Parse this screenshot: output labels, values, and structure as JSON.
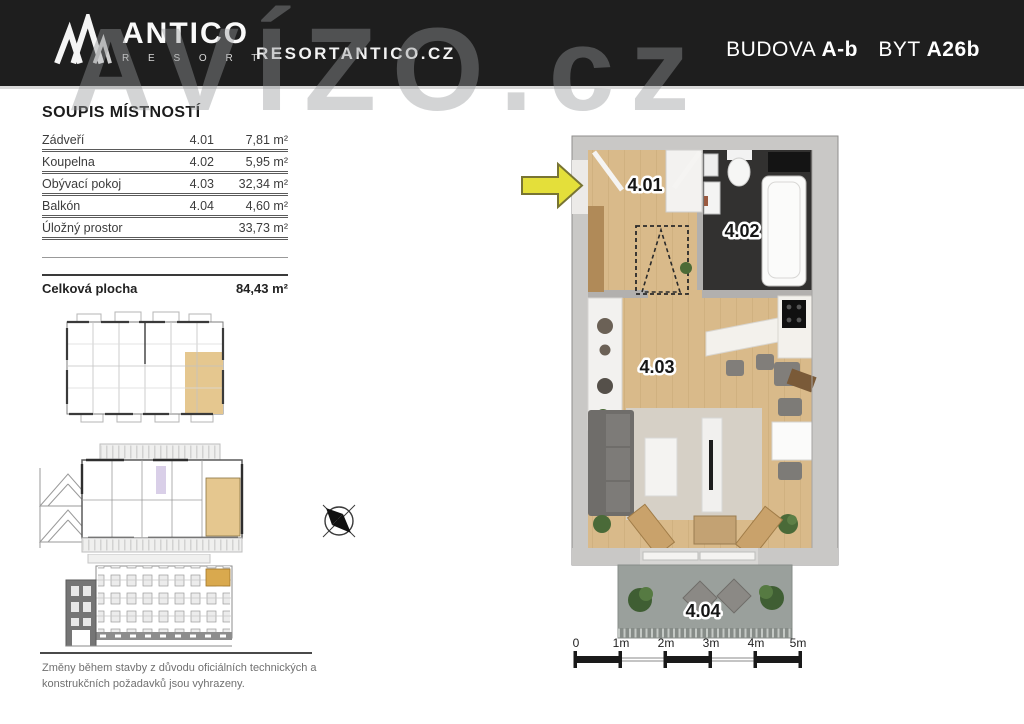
{
  "header": {
    "logo": {
      "brand": "ANTICO",
      "sub": "R E S O R T"
    },
    "website": "RESORTANTICO.CZ",
    "title": {
      "building_label": "BUDOVA",
      "building_value": "A-b",
      "unit_label": "BYT",
      "unit_value": "A26b"
    }
  },
  "watermark": "AVÍZO.cz",
  "room_list": {
    "title": "SOUPIS MÍSTNOSTÍ",
    "rows": [
      {
        "name": "Zádveří",
        "code": "4.01",
        "area": "7,81 m²"
      },
      {
        "name": "Koupelna",
        "code": "4.02",
        "area": "5,95 m²"
      },
      {
        "name": "Obývací pokoj",
        "code": "4.03",
        "area": "32,34 m²"
      },
      {
        "name": "Balkón",
        "code": "4.04",
        "area": "4,60 m²"
      },
      {
        "name": "Úložný prostor",
        "code": "",
        "area": "33,73 m²"
      }
    ],
    "total": {
      "label": "Celková plocha",
      "area": "84,43 m²"
    }
  },
  "floor_plan": {
    "labels": {
      "hall": "4.01",
      "bathroom": "4.02",
      "living": "4.03",
      "balcony": "4.04"
    }
  },
  "scale_bar": {
    "labels": [
      "0",
      "1m",
      "2m",
      "3m",
      "4m",
      "5m"
    ]
  },
  "disclaimer": {
    "line1": "Změny během stavby z důvodu oficiálních technických a",
    "line2": "konstrukčních požadavků jsou vyhrazeny."
  },
  "colors": {
    "header_bg": "#1e1e1e",
    "highlight_tan": "#e5c78f",
    "arrow_yellow": "#e4df3a",
    "wood_floor": "#d9ba8a",
    "bathroom_dark": "#323130",
    "wall_gray": "#c9c8c6"
  }
}
